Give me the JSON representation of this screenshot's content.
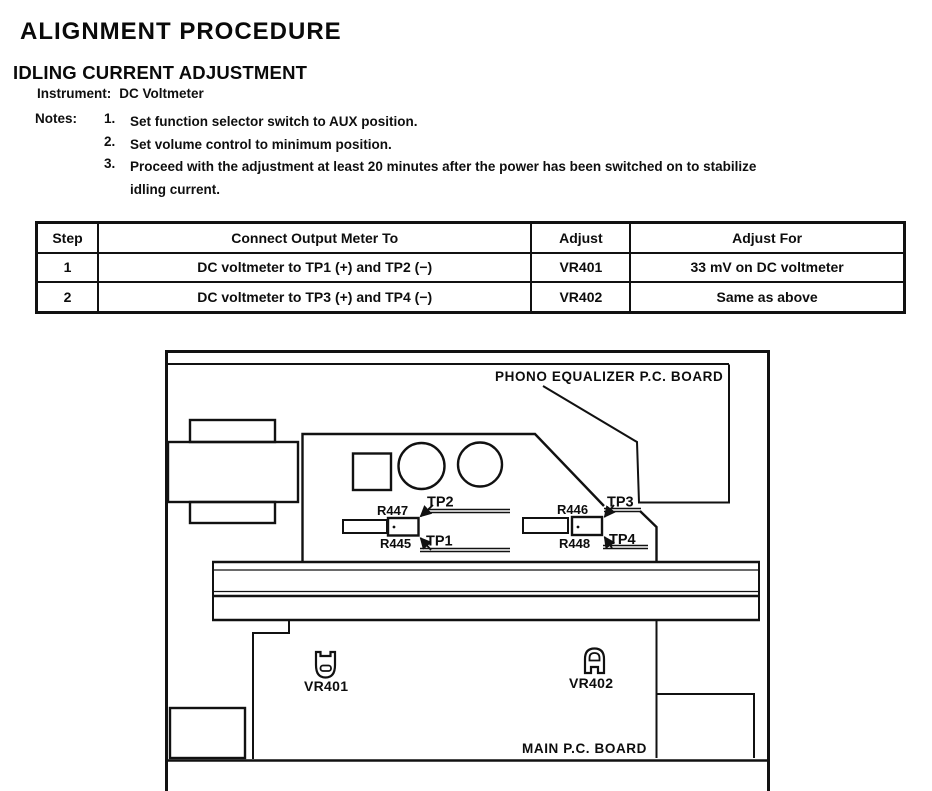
{
  "page": {
    "title": "ALIGNMENT PROCEDURE",
    "section": "IDLING CURRENT ADJUSTMENT"
  },
  "setup": {
    "instrument_label": "Instrument:",
    "instrument_value": "DC Voltmeter",
    "notes_label": "Notes:",
    "notes": [
      {
        "num": "1.",
        "lines": [
          "Set function selector switch to AUX position."
        ]
      },
      {
        "num": "2.",
        "lines": [
          "Set volume control to minimum position."
        ]
      },
      {
        "num": "3.",
        "lines": [
          "Proceed with the adjustment at least 20 minutes after the power has been switched on to stabilize",
          "idling current."
        ]
      }
    ]
  },
  "table": {
    "headers": [
      "Step",
      "Connect Output Meter To",
      "Adjust",
      "Adjust For"
    ],
    "rows": [
      [
        "1",
        "DC voltmeter to TP1 (+) and TP2 (−)",
        "VR401",
        "33 mV on DC voltmeter"
      ],
      [
        "2",
        "DC voltmeter to TP3 (+) and TP4 (−)",
        "VR402",
        "Same as above"
      ]
    ]
  },
  "diagram": {
    "phono_board_label": "PHONO EQUALIZER P.C. BOARD",
    "main_board_label": "MAIN P.C. BOARD",
    "labels": {
      "tp1": "TP1",
      "tp2": "TP2",
      "tp3": "TP3",
      "tp4": "TP4",
      "r445": "R445",
      "r446": "R446",
      "r447": "R447",
      "r448": "R448",
      "vr401": "VR401",
      "vr402": "VR402"
    },
    "line_color": "#111111"
  }
}
